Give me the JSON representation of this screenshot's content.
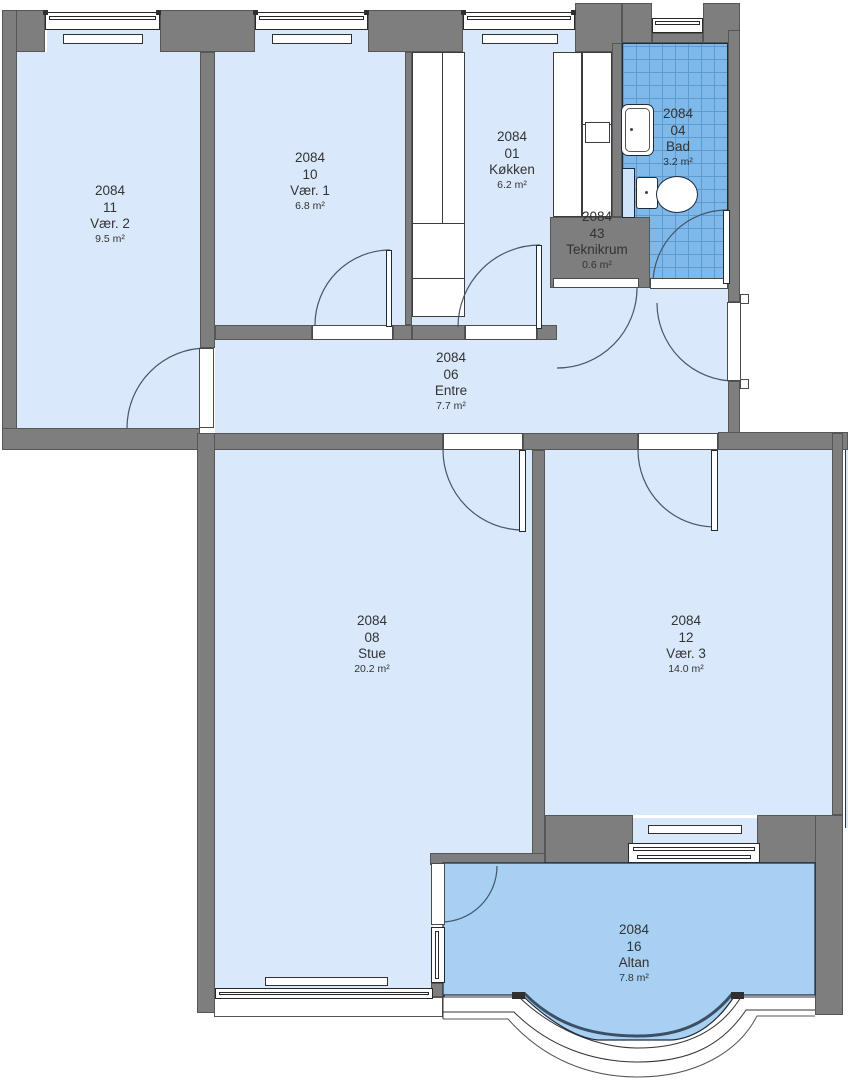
{
  "plan": {
    "unit_id": "2084",
    "type": "apartment-floor-plan"
  },
  "rooms": {
    "vaer2": {
      "unit": "2084",
      "room_no": "11",
      "name": "Vær. 2",
      "area": "9.5 m²"
    },
    "vaer1": {
      "unit": "2084",
      "room_no": "10",
      "name": "Vær. 1",
      "area": "6.8 m²"
    },
    "koekken": {
      "unit": "2084",
      "room_no": "01",
      "name": "Køkken",
      "area": "6.2 m²"
    },
    "bad": {
      "unit": "2084",
      "room_no": "04",
      "name": "Bad",
      "area": "3.2 m²"
    },
    "teknikrum": {
      "unit": "2084",
      "room_no": "43",
      "name": "Teknikrum",
      "area": "0.6 m²"
    },
    "entre": {
      "unit": "2084",
      "room_no": "06",
      "name": "Entre",
      "area": "7.7 m²"
    },
    "stue": {
      "unit": "2084",
      "room_no": "08",
      "name": "Stue",
      "area": "20.2 m²"
    },
    "vaer3": {
      "unit": "2084",
      "room_no": "12",
      "name": "Vær. 3",
      "area": "14.0 m²"
    },
    "altan": {
      "unit": "2084",
      "room_no": "16",
      "name": "Altan",
      "area": "7.8 m²"
    }
  },
  "colors": {
    "room_fill": "#d9e9fb",
    "balcony_fill": "#a8d0f2",
    "bath_tile": "#7fb9e9",
    "wall_gray": "#7e7e7e"
  }
}
